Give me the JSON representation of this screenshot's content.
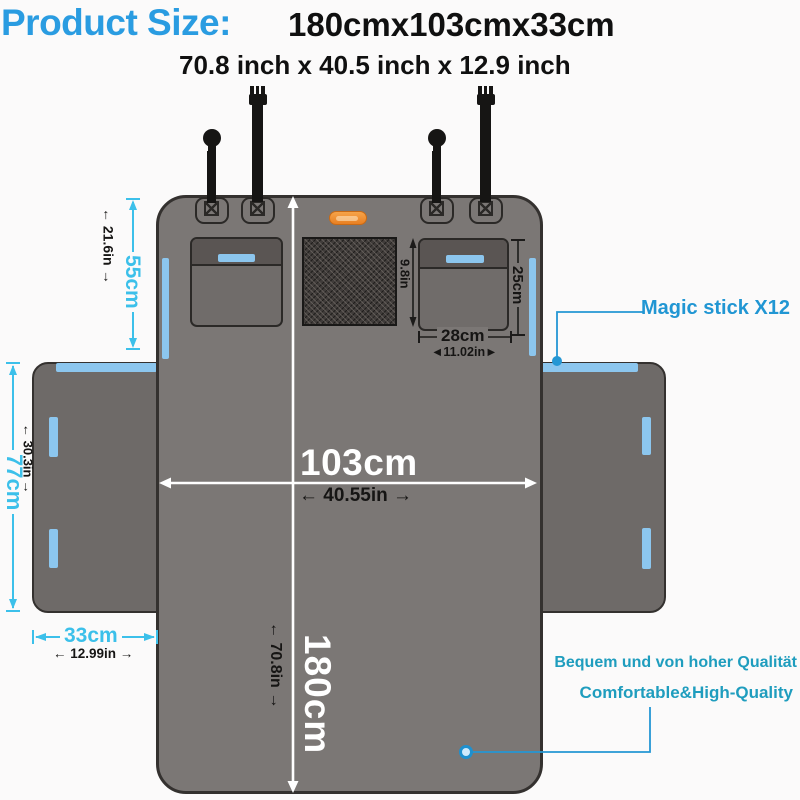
{
  "title": {
    "label": "Product Size:",
    "size_cm": "180cmx103cmx33cm",
    "size_inch": "70.8 inch x 40.5 inch x 12.9 inch"
  },
  "dims": {
    "pocket_height_cm": "55cm",
    "pocket_height_in": "21.6in",
    "mesh_height_in": "9.8in",
    "side_pocket_height_cm": "25cm",
    "side_pocket_width_cm": "28cm",
    "side_pocket_width_in": "11.02in",
    "width_cm": "103cm",
    "width_in": "40.55in",
    "length_cm": "180cm",
    "length_in": "70.8in",
    "flap_height_cm": "77cm",
    "flap_height_in": "30.3in",
    "flap_width_cm": "33cm",
    "flap_width_in": "12.99in"
  },
  "callouts": {
    "magic_stick": "Magic stick X12",
    "quality_de": "Bequem und von hoher Qualität",
    "quality_en": "Comfortable&High-Quality"
  },
  "colors": {
    "title_blue": "#2a9ce1",
    "dimension_cyan": "#3cc0ea",
    "callout_blue": "#2196d3",
    "quality_teal": "#1f9dbe",
    "velcro_strip_blue": "#8cc6ee",
    "badge_orange": "#ef8a2d",
    "cover_gray": "#7b7775",
    "flap_gray": "#6e6a68"
  }
}
